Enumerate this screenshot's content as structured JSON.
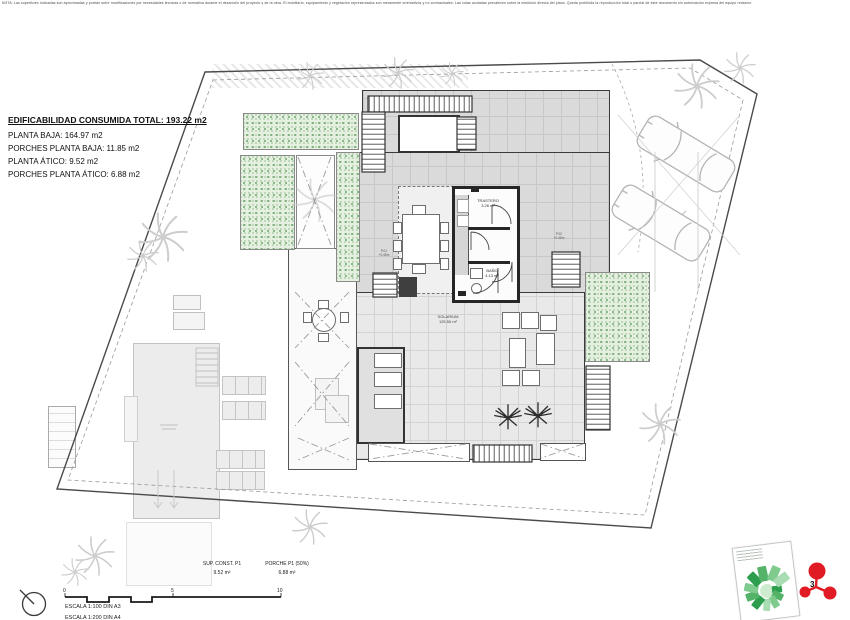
{
  "sheet": {
    "top_disclaimer": "NOTA: Las superficies indicadas son aproximadas y podrán sufrir modificaciones por necesidades técnicas o de normativa durante el desarrollo del proyecto y de la obra. El mobiliario, equipamiento y vegetación representados son meramente orientativos y no contractuales. Las cotas acotadas prevalecen sobre la medición directa del plano. Queda prohibida la reproducción total o parcial de este documento sin autorización expresa del equipo redactor."
  },
  "summary": {
    "title": "EDIFICABILIDAD CONSUMIDA TOTAL: 193.22 m2",
    "lines": [
      "PLANTA BAJA: 164.97 m2",
      "PORCHES PLANTA BAJA: 11.85 m2",
      "PLANTA ÁTICO: 9.52 m2",
      "PORCHES PLANTA ÁTICO: 6.88 m2"
    ]
  },
  "plan": {
    "solarium_name": "SOLARIUM",
    "solarium_area": "125.50 m²",
    "trastero_name": "TRASTERO",
    "trastero_area": "3.26 m²",
    "bano_name": "BAÑO",
    "bano_area": "4.13 m²",
    "level_left_1": "P.01",
    "level_left_2": "+0.45m",
    "level_right_1": "P.02",
    "level_right_2": "+0.45m"
  },
  "area_table": {
    "col1_header": "SUP. CONST. P1",
    "col2_header": "PORCHE P1 (50%)",
    "col1_value": "9.52 m²",
    "col2_value": "6.88 m²"
  },
  "scale": {
    "label_primary": "ESCALA 1:100 DIN A3",
    "label_secondary": "ESCALA 1:200 DIN A4",
    "tick_0": "0",
    "tick_5": "5",
    "tick_10": "10"
  },
  "logo": {
    "glyph": "3",
    "accent_red": "#e01b24"
  }
}
